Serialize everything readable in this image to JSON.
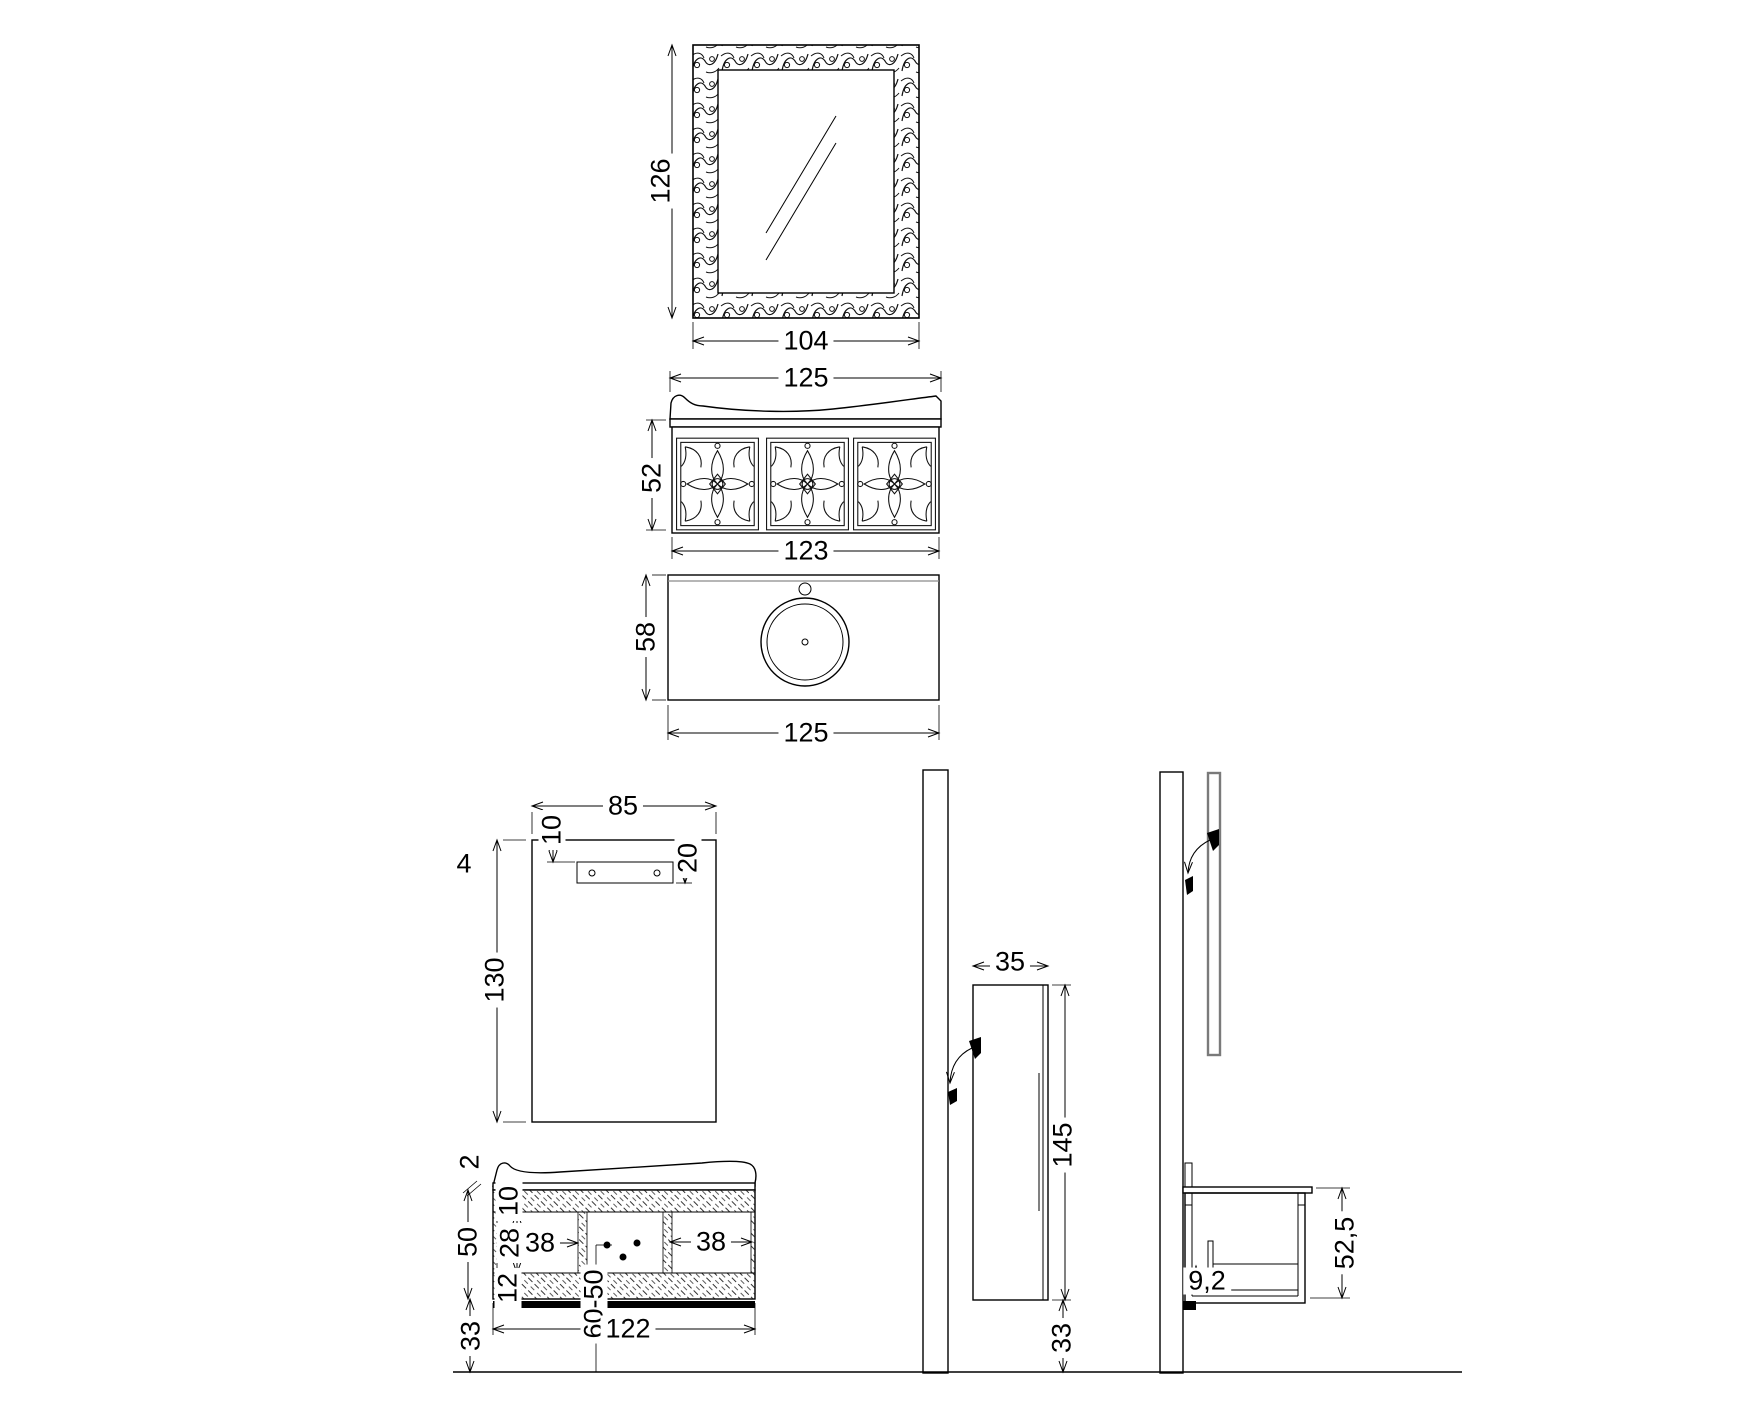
{
  "drawing_title": "bathroom-vanity-set-technical-drawing",
  "colors": {
    "background": "#ffffff",
    "line": "#000000",
    "mirror_strip": "#7a7a7a"
  },
  "views": {
    "mirror_front": {
      "label_height": "126",
      "label_width": "104"
    },
    "vanity_front": {
      "label_top_width": "125",
      "label_height": "52",
      "label_body_width": "123"
    },
    "washbasin_top": {
      "label_depth": "58",
      "label_width": "125"
    },
    "mirror_back": {
      "label_width": "85",
      "label_bracket_top": "10",
      "label_bracket_bottom": "20",
      "label_depth": "4",
      "label_height": "130"
    },
    "vanity_section": {
      "label_counter_thickness": "2",
      "label_body_height": "50",
      "label_top_panel": "10",
      "label_opening_height": "28",
      "label_bottom_panel": "12",
      "label_left_door_width": "38",
      "label_right_door_width": "38",
      "label_drain_position": "60-50",
      "label_body_width": "122",
      "label_floor_clearance": "33"
    },
    "side_elevation": {
      "label_depth": "35",
      "label_height": "145",
      "label_floor_clearance": "33"
    },
    "wall_section": {
      "label_worktop_height": "52,5",
      "label_drawer_clearance": "9,2"
    }
  }
}
